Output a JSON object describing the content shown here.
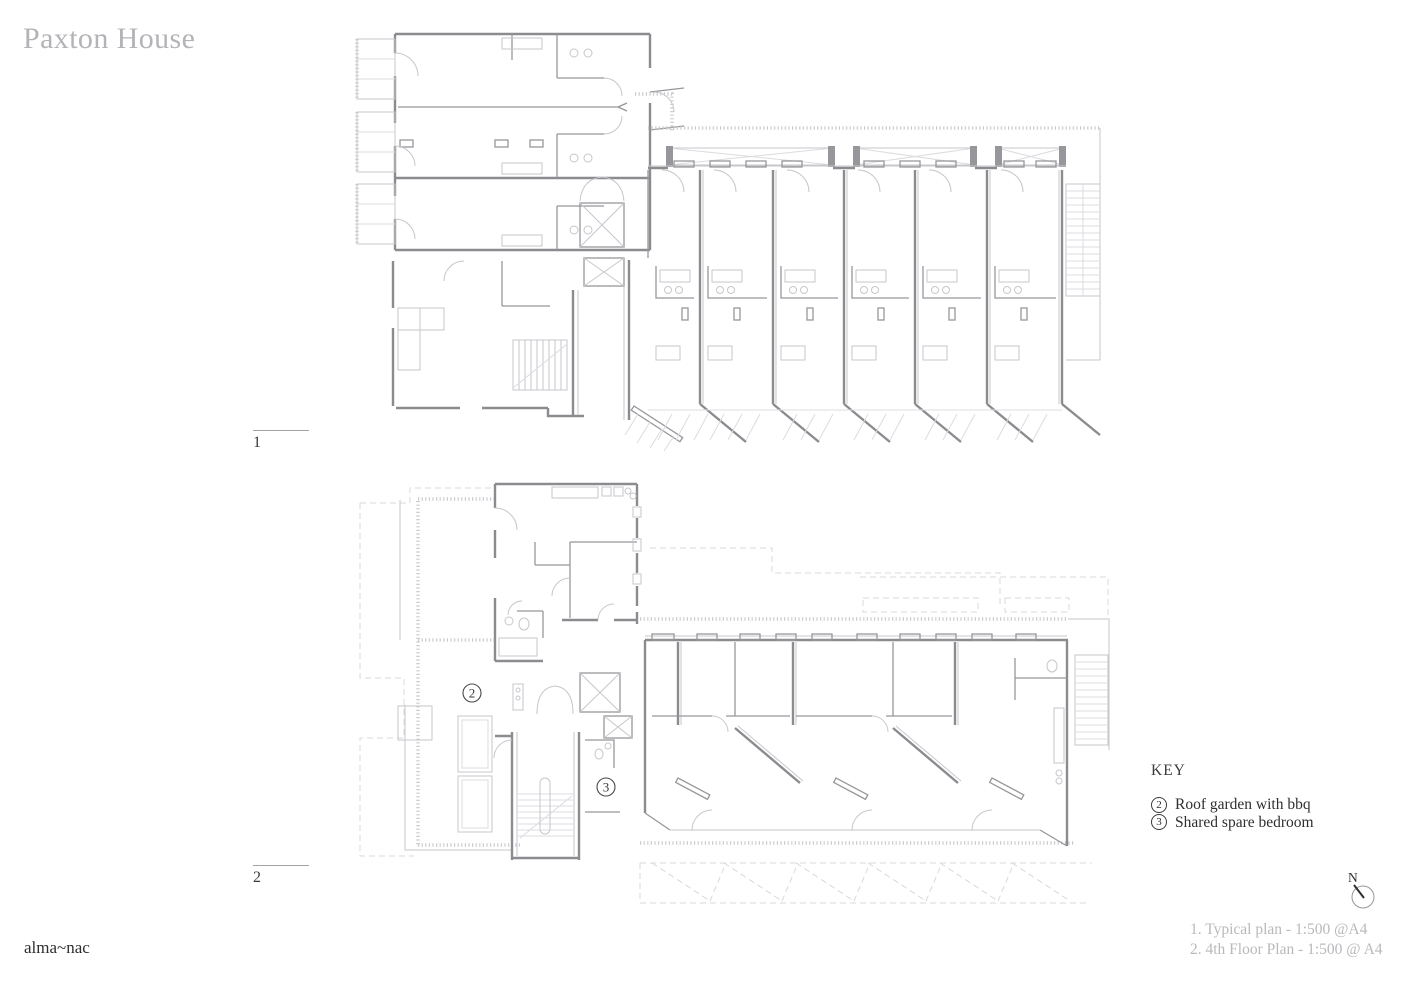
{
  "header": {
    "title": "Paxton House"
  },
  "figures": [
    {
      "label": "1",
      "name": "Typical plan",
      "caption": "1. Typical plan - 1:500 @A4"
    },
    {
      "label": "2",
      "name": "4th Floor Plan",
      "caption": "2. 4th Floor Plan - 1:500 @ A4"
    }
  ],
  "key": {
    "heading": "KEY",
    "items": [
      {
        "number": "2",
        "label": "Roof garden with bbq"
      },
      {
        "number": "3",
        "label": "Shared spare bedroom"
      }
    ]
  },
  "plan_markers": {
    "roof_garden": "2",
    "spare_bedroom": "3"
  },
  "compass": {
    "label": "N"
  },
  "footer": {
    "logo": "alma~nac"
  },
  "colors": {
    "background": "#ffffff",
    "title_text": "#b4b4b8",
    "caption_text": "#b9b9bc",
    "key_text": "#2f2f31",
    "wall_primary": "#8c8c90",
    "wall_secondary": "#97979b",
    "detail_light": "#c7c7cc",
    "dashed_below": "#d9d9de"
  }
}
